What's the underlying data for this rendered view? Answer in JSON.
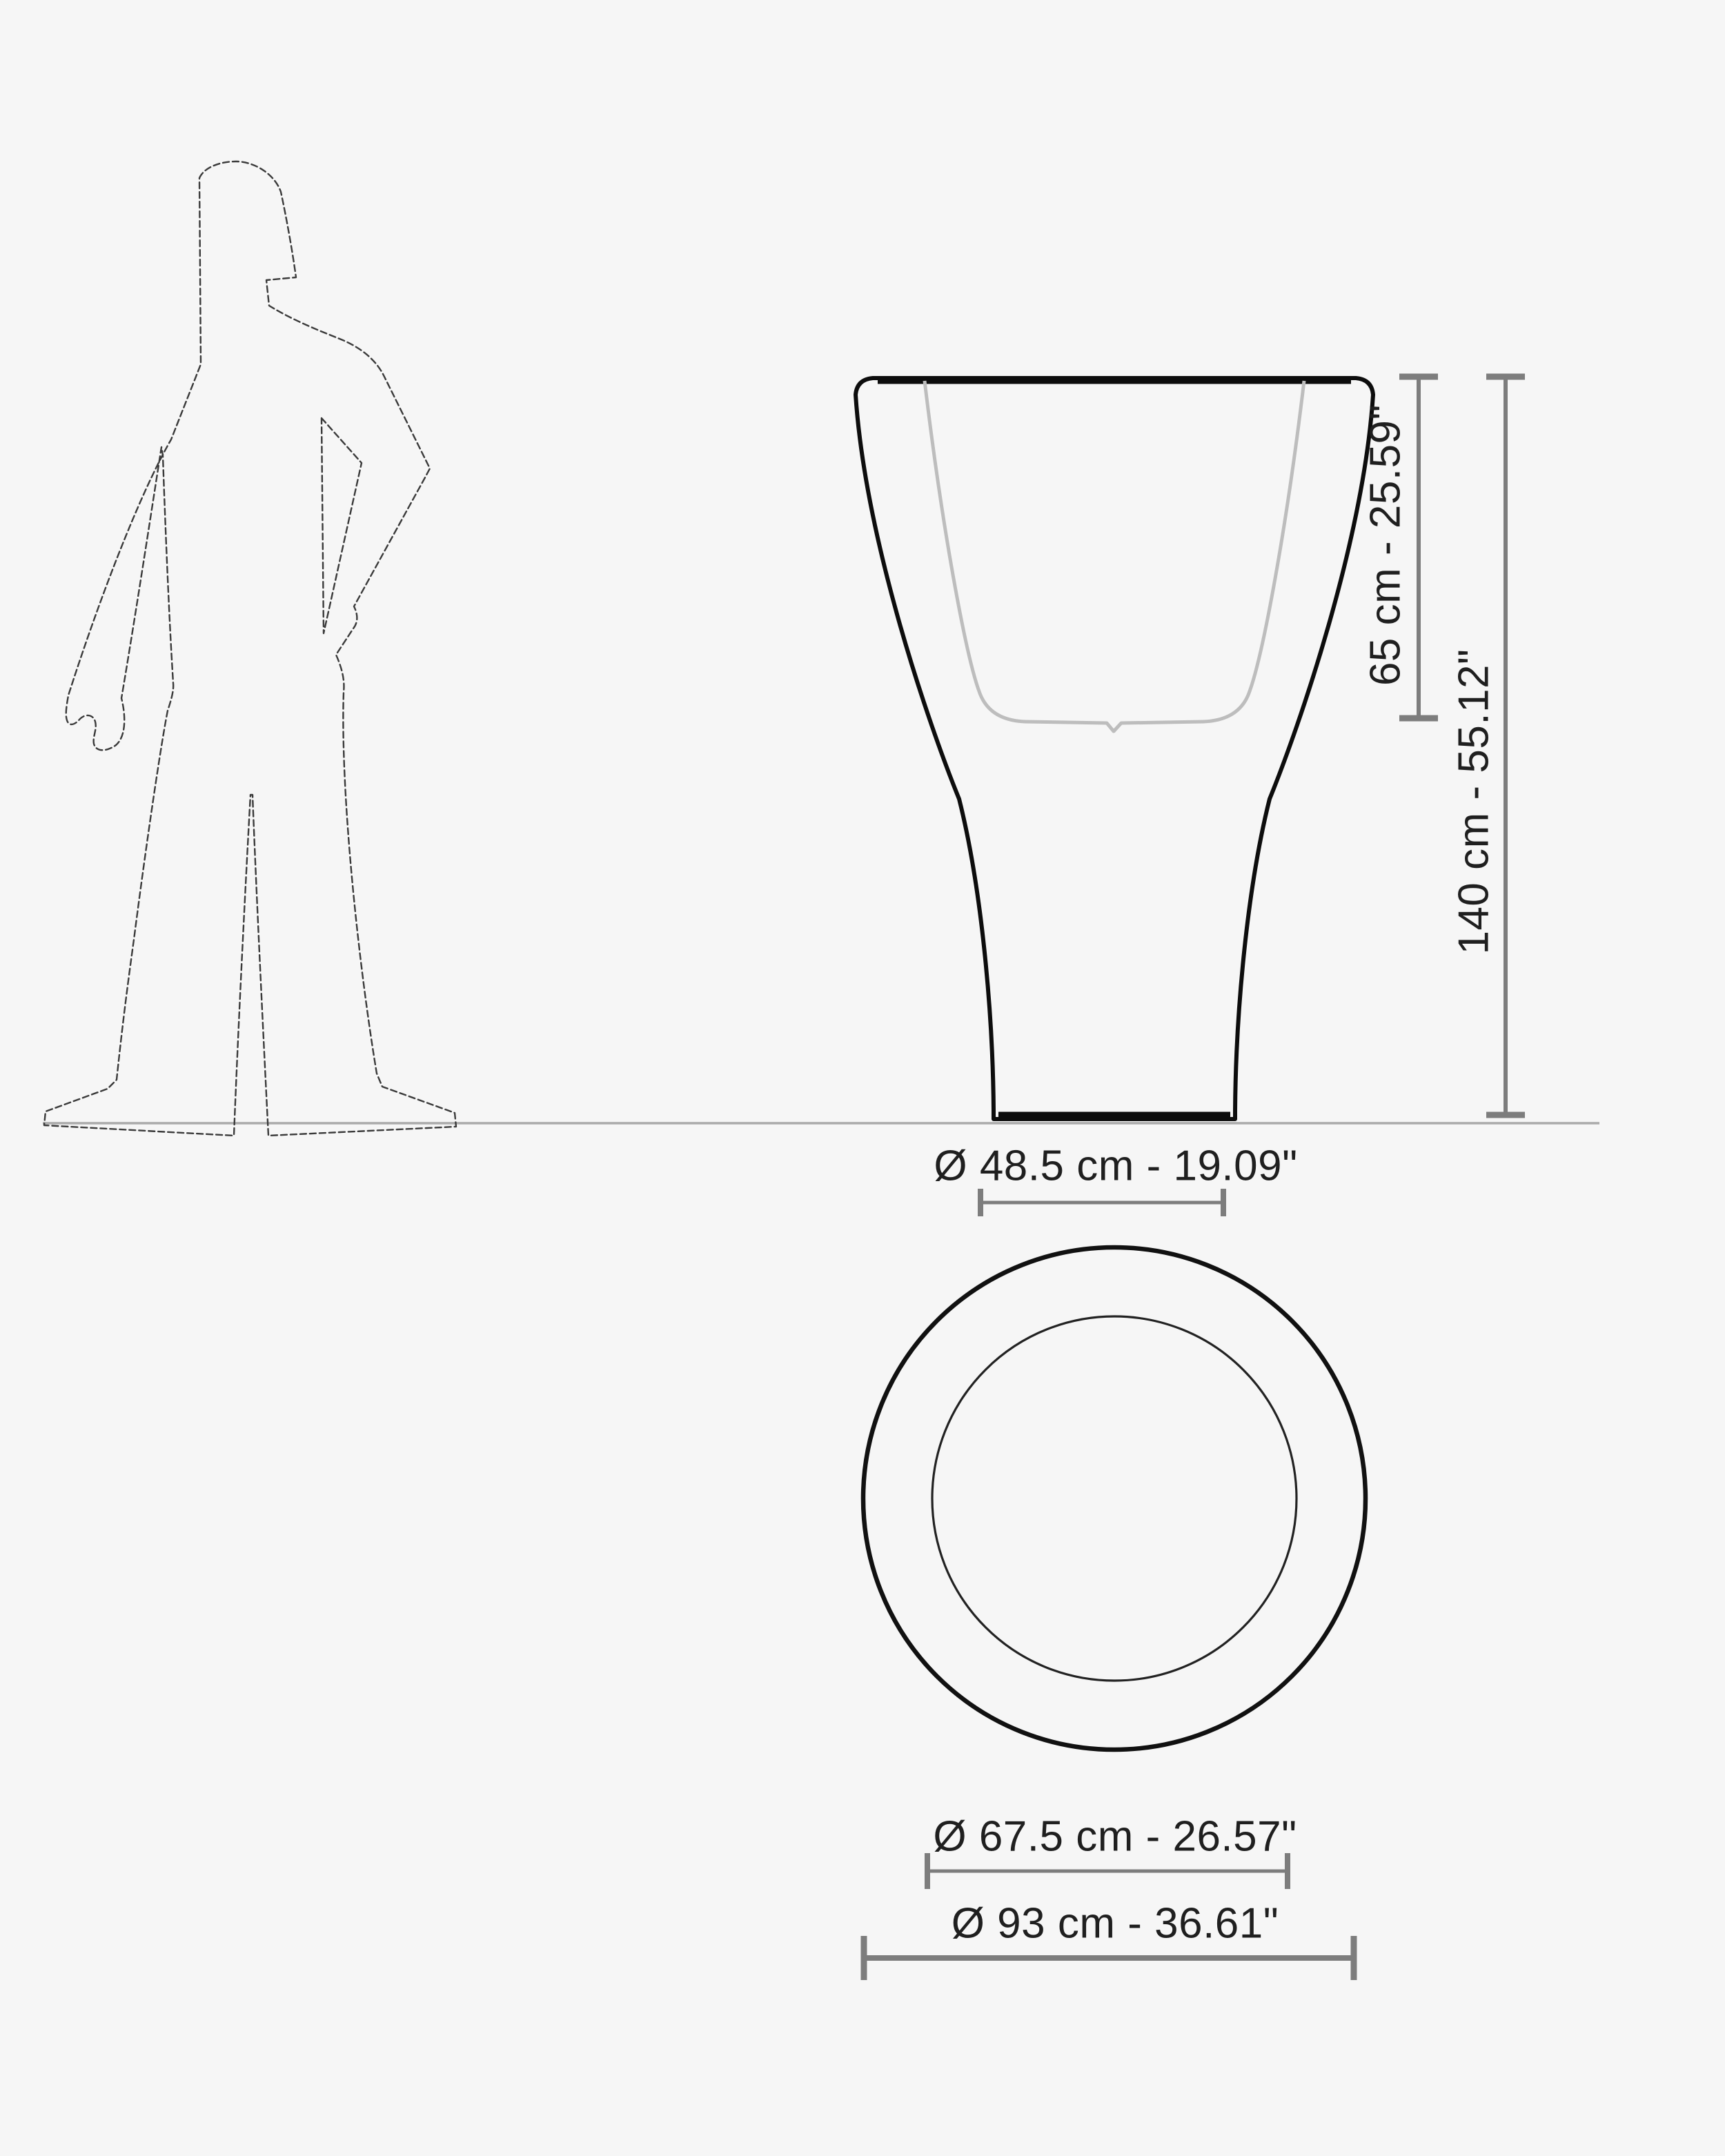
{
  "page": {
    "background_color": "#f6f6f6",
    "kind": "product dimension drawing",
    "views": [
      "front elevation with human figure for scale",
      "top view"
    ]
  },
  "colors": {
    "outline_black": "#0d0d0d",
    "inner_line_gray": "#bdbdbd",
    "dimension_gray": "#7d7d7d",
    "ground_gray": "#ababab",
    "figure_gray": "#3a3a3a",
    "text_dark": "#1f1f1f"
  },
  "dimensions": {
    "inner_height": {
      "label": "65 cm - 25.59\"",
      "cm": 65,
      "inches": 25.59
    },
    "total_height": {
      "label": "140 cm - 55.12\"",
      "cm": 140,
      "inches": 55.12
    },
    "base_diameter": {
      "label": "Ø 48.5 cm - 19.09\"",
      "cm": 48.5,
      "inches": 19.09
    },
    "inner_diameter": {
      "label": "Ø 67.5 cm - 26.57\"",
      "cm": 67.5,
      "inches": 26.57
    },
    "outer_diameter": {
      "label": "Ø 93 cm - 36.61\"",
      "cm": 93,
      "inches": 36.61
    }
  },
  "icons": {
    "human_silhouette": "standing man outline, hand on hip, scale reference",
    "planter_front": "flared vase/planter front profile with inner cavity line",
    "planter_top": "top view concentric circles"
  }
}
